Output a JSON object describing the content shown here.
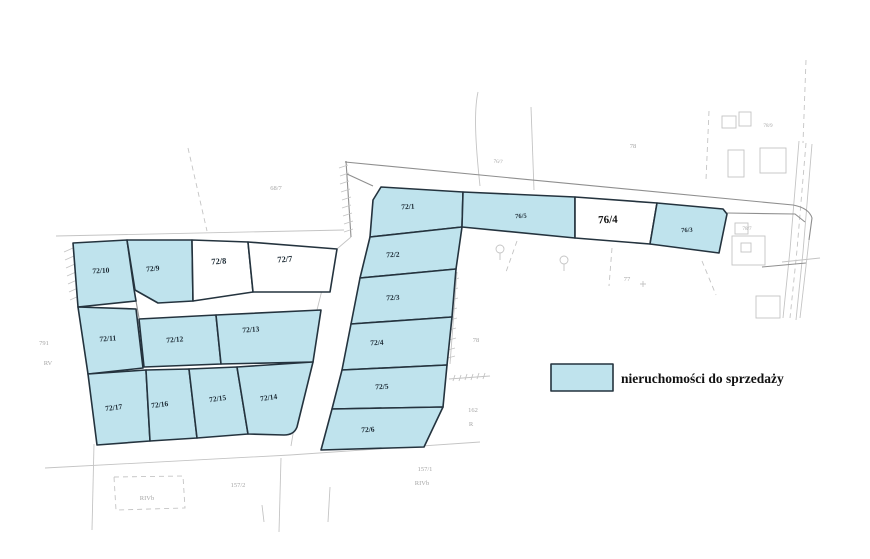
{
  "colors": {
    "parcel_fill": "#bfe3ed",
    "parcel_stroke": "#24333e",
    "background_line": "#c4c4c4",
    "label": "#1c2a34",
    "faint_label": "#a6a6a6",
    "legend_text": "#111111"
  },
  "legend": {
    "label": "nieruchomości do sprzedaży"
  },
  "parcels": [
    {
      "id": "72/10",
      "label": "72/10",
      "for_sale": true
    },
    {
      "id": "72/9",
      "label": "72/9",
      "for_sale": true
    },
    {
      "id": "72/8",
      "label": "72/8",
      "for_sale": false
    },
    {
      "id": "72/7",
      "label": "72/7",
      "for_sale": false
    },
    {
      "id": "72/11",
      "label": "72/11",
      "for_sale": true
    },
    {
      "id": "72/12",
      "label": "72/12",
      "for_sale": true
    },
    {
      "id": "72/13",
      "label": "72/13",
      "for_sale": true
    },
    {
      "id": "72/17",
      "label": "72/17",
      "for_sale": true
    },
    {
      "id": "72/16",
      "label": "72/16",
      "for_sale": true
    },
    {
      "id": "72/15",
      "label": "72/15",
      "for_sale": true
    },
    {
      "id": "72/14",
      "label": "72/14",
      "for_sale": true
    },
    {
      "id": "72/1",
      "label": "72/1",
      "for_sale": true
    },
    {
      "id": "72/2",
      "label": "72/2",
      "for_sale": true
    },
    {
      "id": "72/3",
      "label": "72/3",
      "for_sale": true
    },
    {
      "id": "72/4",
      "label": "72/4",
      "for_sale": true
    },
    {
      "id": "72/5",
      "label": "72/5",
      "for_sale": true
    },
    {
      "id": "72/6",
      "label": "72/6",
      "for_sale": true
    },
    {
      "id": "76/5",
      "label": "76/5",
      "for_sale": true
    },
    {
      "id": "76/4",
      "label": "76/4",
      "for_sale": false
    },
    {
      "id": "76/3",
      "label": "76/3",
      "for_sale": true
    }
  ],
  "background_labels": [
    {
      "id": "68/7",
      "label": "68/7"
    },
    {
      "id": "791",
      "label": "791"
    },
    {
      "id": "RV",
      "label": "RV"
    },
    {
      "id": "78-mid",
      "label": "78"
    },
    {
      "id": "162",
      "label": "162"
    },
    {
      "id": "R",
      "label": "R"
    },
    {
      "id": "157/2",
      "label": "157/2"
    },
    {
      "id": "RIVb-1",
      "label": "RIVb"
    },
    {
      "id": "157/1",
      "label": "157/1"
    },
    {
      "id": "RIVb-2",
      "label": "RIVb"
    },
    {
      "id": "78-top",
      "label": "78"
    },
    {
      "id": "77",
      "label": "77"
    },
    {
      "id": "76/7",
      "label": "76/7"
    },
    {
      "id": "78/7",
      "label": "78/7"
    },
    {
      "id": "78/9",
      "label": "78/9"
    }
  ]
}
